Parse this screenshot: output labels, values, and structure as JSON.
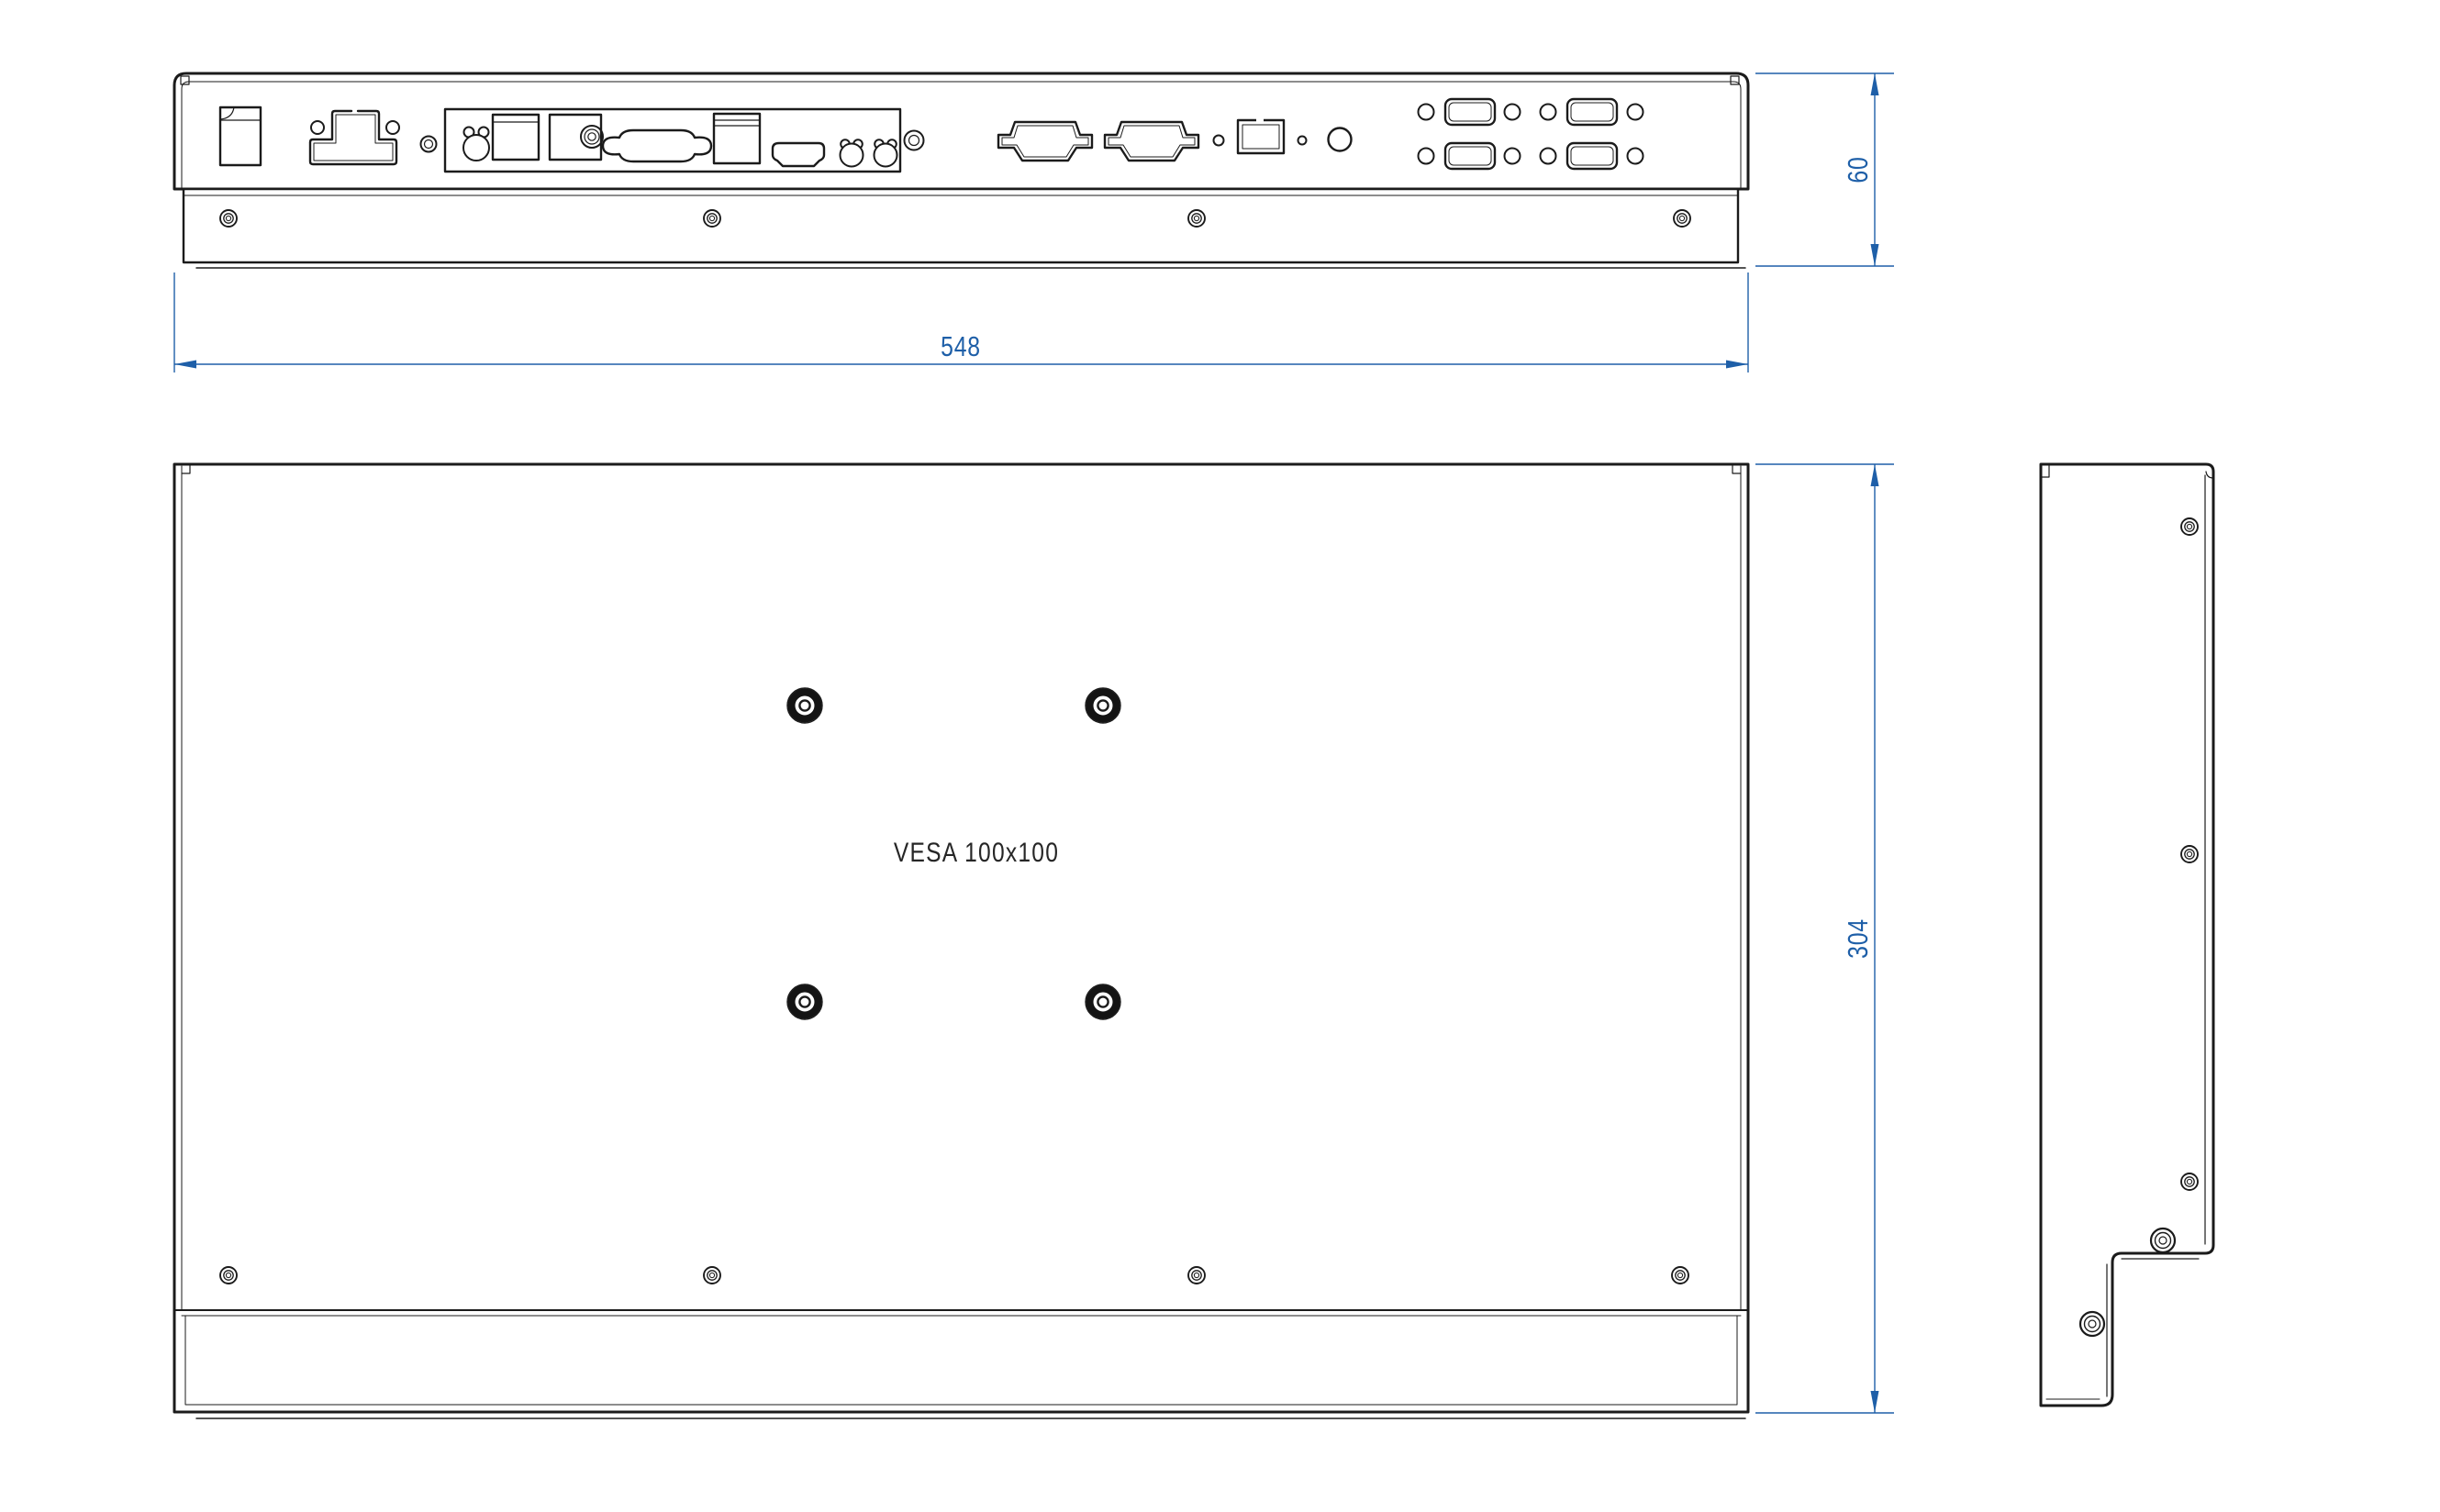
{
  "sheet": {
    "background": "#ffffff",
    "line_color": "#1b1b1b",
    "dimension_color": "#1e5fa8"
  },
  "labels": {
    "vesa": "VESA 100x100"
  },
  "dimensions": {
    "width": {
      "value": "548"
    },
    "depth": {
      "value": "60"
    },
    "height": {
      "value": "304"
    }
  },
  "icons": {
    "screw": "concentric-circles",
    "vesa_screw": "knurled-ring-with-center-hole",
    "dimension_arrow": "filled-triangle"
  }
}
